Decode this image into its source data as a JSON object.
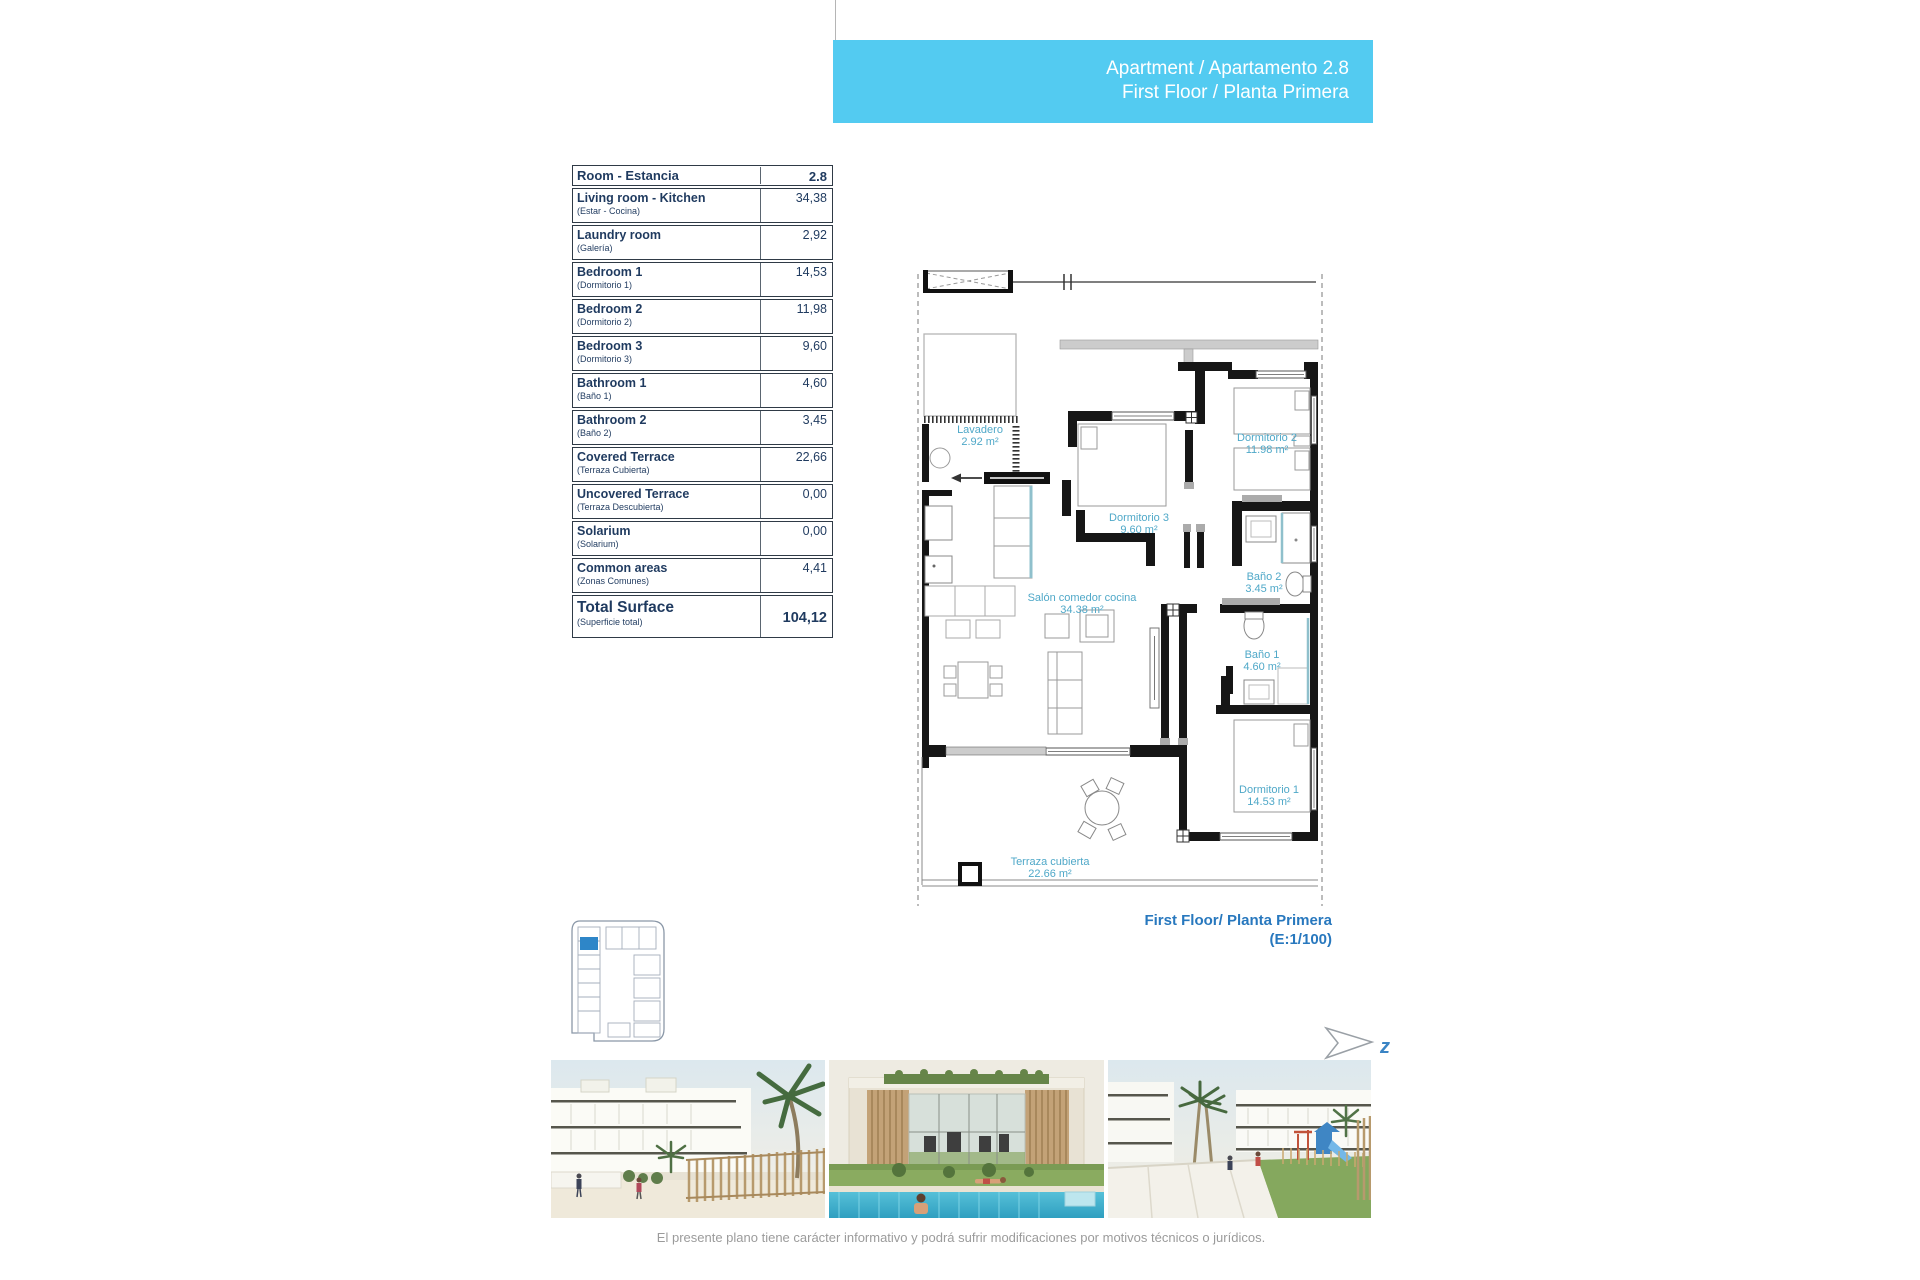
{
  "header_box": {
    "line1": "Apartment / Apartamento 2.8",
    "line2": "First Floor / Planta Primera",
    "bg_color": "#53cbf1",
    "text_color": "#ffffff"
  },
  "area_table": {
    "header": {
      "label": "Room - Estancia",
      "value": "2.8"
    },
    "rows": [
      {
        "label": "Living room - Kitchen",
        "sublabel": "(Estar - Cocina)",
        "value": "34,38"
      },
      {
        "label": "Laundry room",
        "sublabel": "(Galería)",
        "value": "2,92"
      },
      {
        "label": "Bedroom 1",
        "sublabel": "(Dormitorio 1)",
        "value": "14,53"
      },
      {
        "label": "Bedroom 2",
        "sublabel": "(Dormitorio 2)",
        "value": "11,98"
      },
      {
        "label": "Bedroom 3",
        "sublabel": "(Dormitorio 3)",
        "value": "9,60"
      },
      {
        "label": "Bathroom 1",
        "sublabel": "(Baño 1)",
        "value": "4,60"
      },
      {
        "label": "Bathroom 2",
        "sublabel": "(Baño 2)",
        "value": "3,45"
      },
      {
        "label": "Covered Terrace",
        "sublabel": "(Terraza Cubierta)",
        "value": "22,66"
      },
      {
        "label": "Uncovered Terrace",
        "sublabel": "(Terraza Descubierta)",
        "value": "0,00"
      },
      {
        "label": "Solarium",
        "sublabel": "(Solarium)",
        "value": "0,00"
      },
      {
        "label": "Common areas",
        "sublabel": "(Zonas Comunes)",
        "value": "4,41"
      }
    ],
    "total": {
      "label": "Total Surface",
      "sublabel": "(Superficie total)",
      "value": "104,12"
    }
  },
  "floor_plan": {
    "rooms": [
      {
        "name": "Lavadero",
        "area": "2.92 m²"
      },
      {
        "name": "Dormitorio 3",
        "area": "9.60 m²"
      },
      {
        "name": "Dormitorio 2",
        "area": "11.98 m²"
      },
      {
        "name": "Baño 2",
        "area": "3.45 m²"
      },
      {
        "name": "Salón comedor cocina",
        "area": "34.38 m²"
      },
      {
        "name": "Baño 1",
        "area": "4.60 m²"
      },
      {
        "name": "Dormitorio 1",
        "area": "14.53 m²"
      },
      {
        "name": "Terraza cubierta",
        "area": "22.66 m²"
      }
    ],
    "caption": {
      "line1": "First Floor/ Planta Primera",
      "line2": "(E:1/100)"
    },
    "north_label": "z",
    "label_color": "#4fa8c8",
    "caption_color": "#2878be"
  },
  "footer": {
    "disclaimer": "El presente plano tiene carácter informativo y podrá sufrir modificaciones por motivos técnicos o jurídicos."
  }
}
